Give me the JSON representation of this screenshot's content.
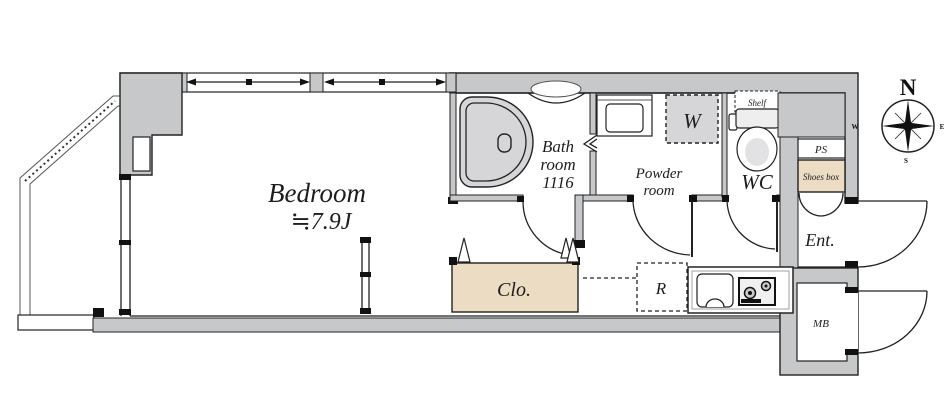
{
  "floorplan": {
    "labels": {
      "bedroom": "Bedroom",
      "bedroom_size": "≒7.9J",
      "bath_1": "Bath",
      "bath_2": "room",
      "bath_3": "1116",
      "powder_1": "Powder",
      "powder_2": "room",
      "washer": "W",
      "wc": "WC",
      "shelf": "Shelf",
      "ps": "PS",
      "shoes_box": "Shoes box",
      "entrance": "Ent.",
      "closet": "Clo.",
      "fridge": "R",
      "meter_box": "MB"
    },
    "compass": {
      "n": "N",
      "e": "E",
      "s": "S",
      "w": "W"
    },
    "colors": {
      "wall_fill": "#c7c8ca",
      "outline": "#222222",
      "accent_beige": "#ecdcc3",
      "fixture_gray": "#d6d6d8"
    }
  }
}
